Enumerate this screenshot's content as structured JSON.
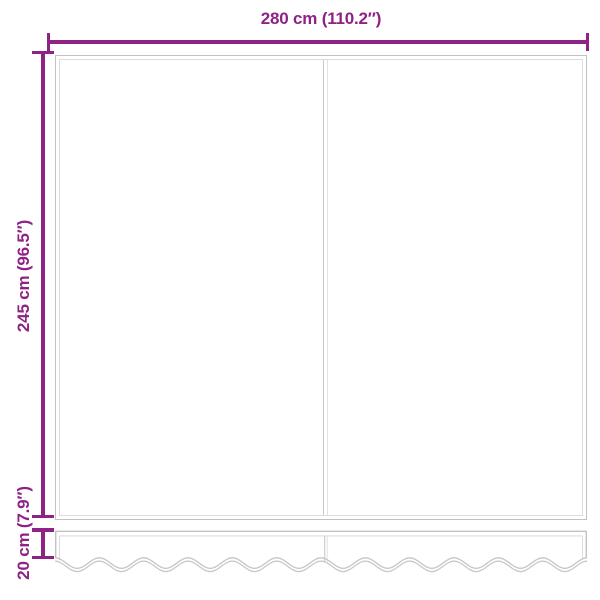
{
  "diagram": {
    "dimensions": {
      "width": {
        "label": "280 cm (110.2″)"
      },
      "height": {
        "label": "245 cm (96.5″)"
      },
      "valance": {
        "label": "20 cm (7.9″)"
      }
    },
    "colors": {
      "dimension_accent": "#8E2285",
      "outline_gray": "#C2C2C2",
      "outline_gray_light": "#DCDCDC"
    },
    "wave": {
      "cycles": 12,
      "x_start": 55,
      "x_end": 587,
      "crest_y": 557.8,
      "amplitude": 10.5,
      "gap": 3.3
    }
  }
}
